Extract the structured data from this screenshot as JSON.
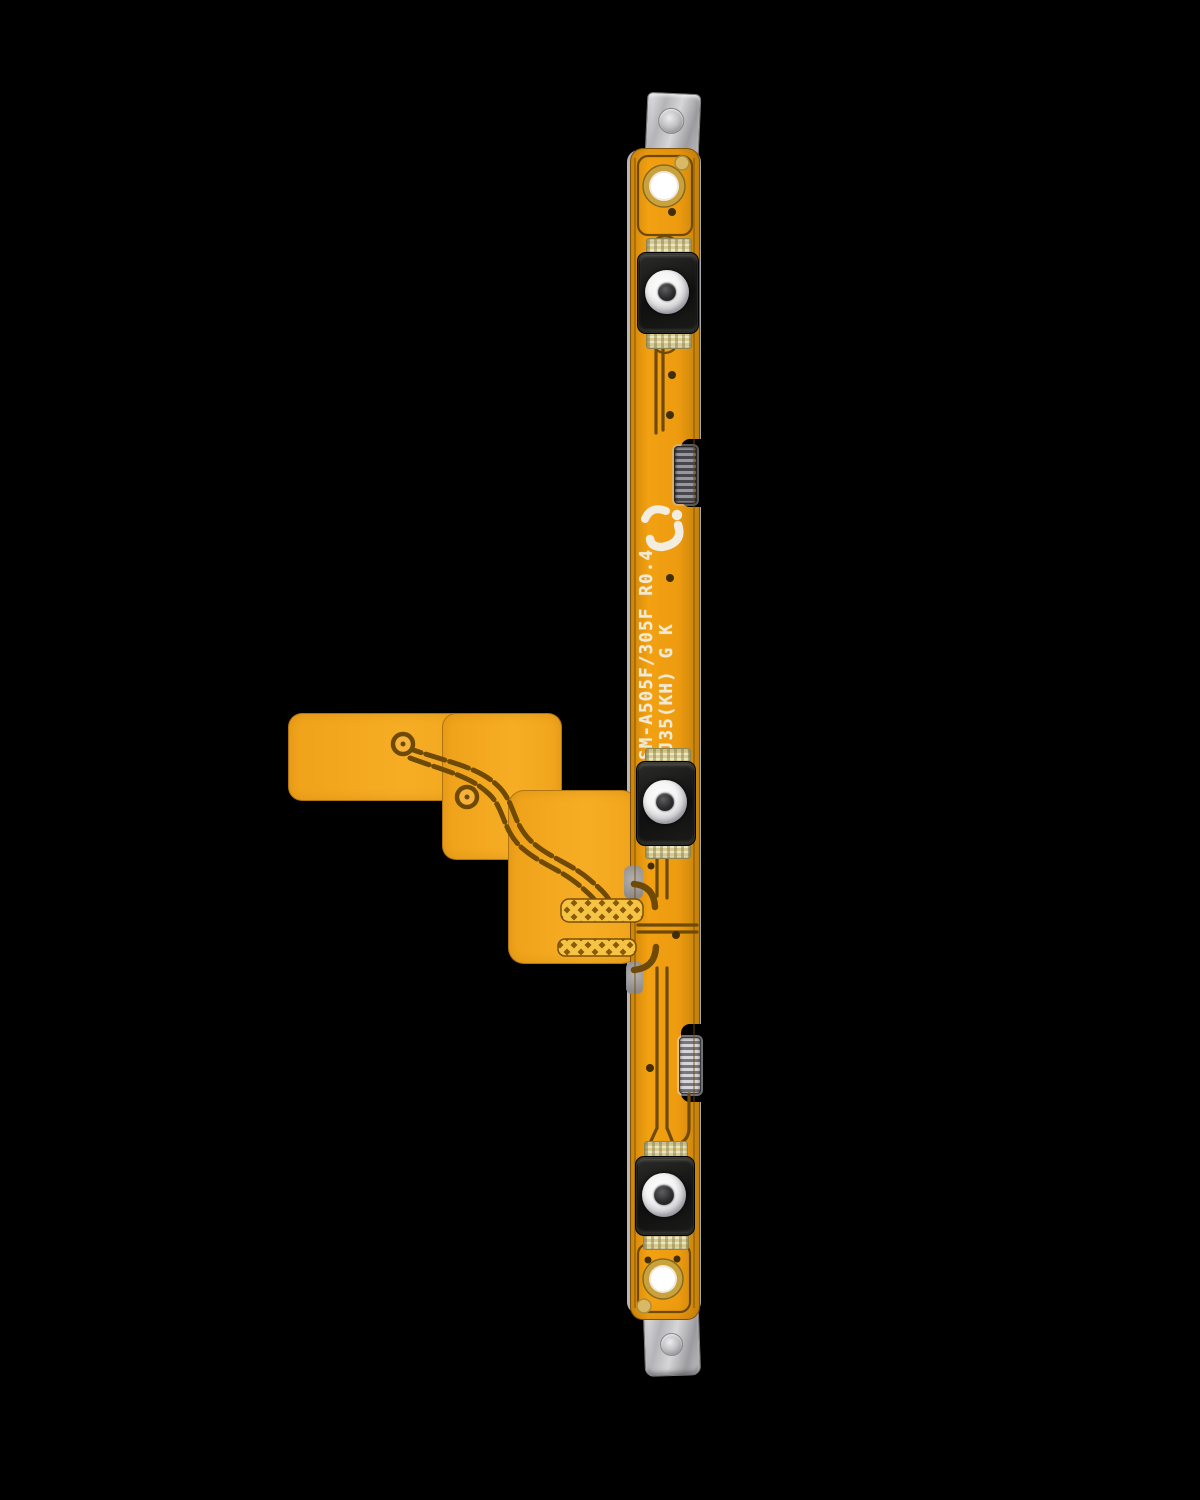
{
  "meta": {
    "type": "product-photograph",
    "subject": "Power and volume button flex cable (replacement part) on black background",
    "background_color": "#000000"
  },
  "silkscreen": {
    "line1": "SM-A505F/305F R0.4",
    "line2": "RJ35(KH) G K"
  },
  "parts": {
    "tactile_switch_count": 3,
    "metal_bracket_count": 2,
    "side_contact_clip_count": 2,
    "screw_hole_count": 2,
    "test_pad_ring_count": 2
  },
  "colors": {
    "flex_orange": "#EE9B10",
    "branch_orange": "#F4A71E",
    "trace_brown": "#6F4A07",
    "crosshatch_yellow": "#F6C445",
    "silkscreen_text": "#F0EAD7",
    "metal_gray": "#C4C4C6",
    "solder_pad_khaki": "#D9CC90",
    "switch_frame_black": "#141414",
    "screw_ring_gold": "#C9A23E",
    "fiducial_tan": "#D9B866"
  }
}
